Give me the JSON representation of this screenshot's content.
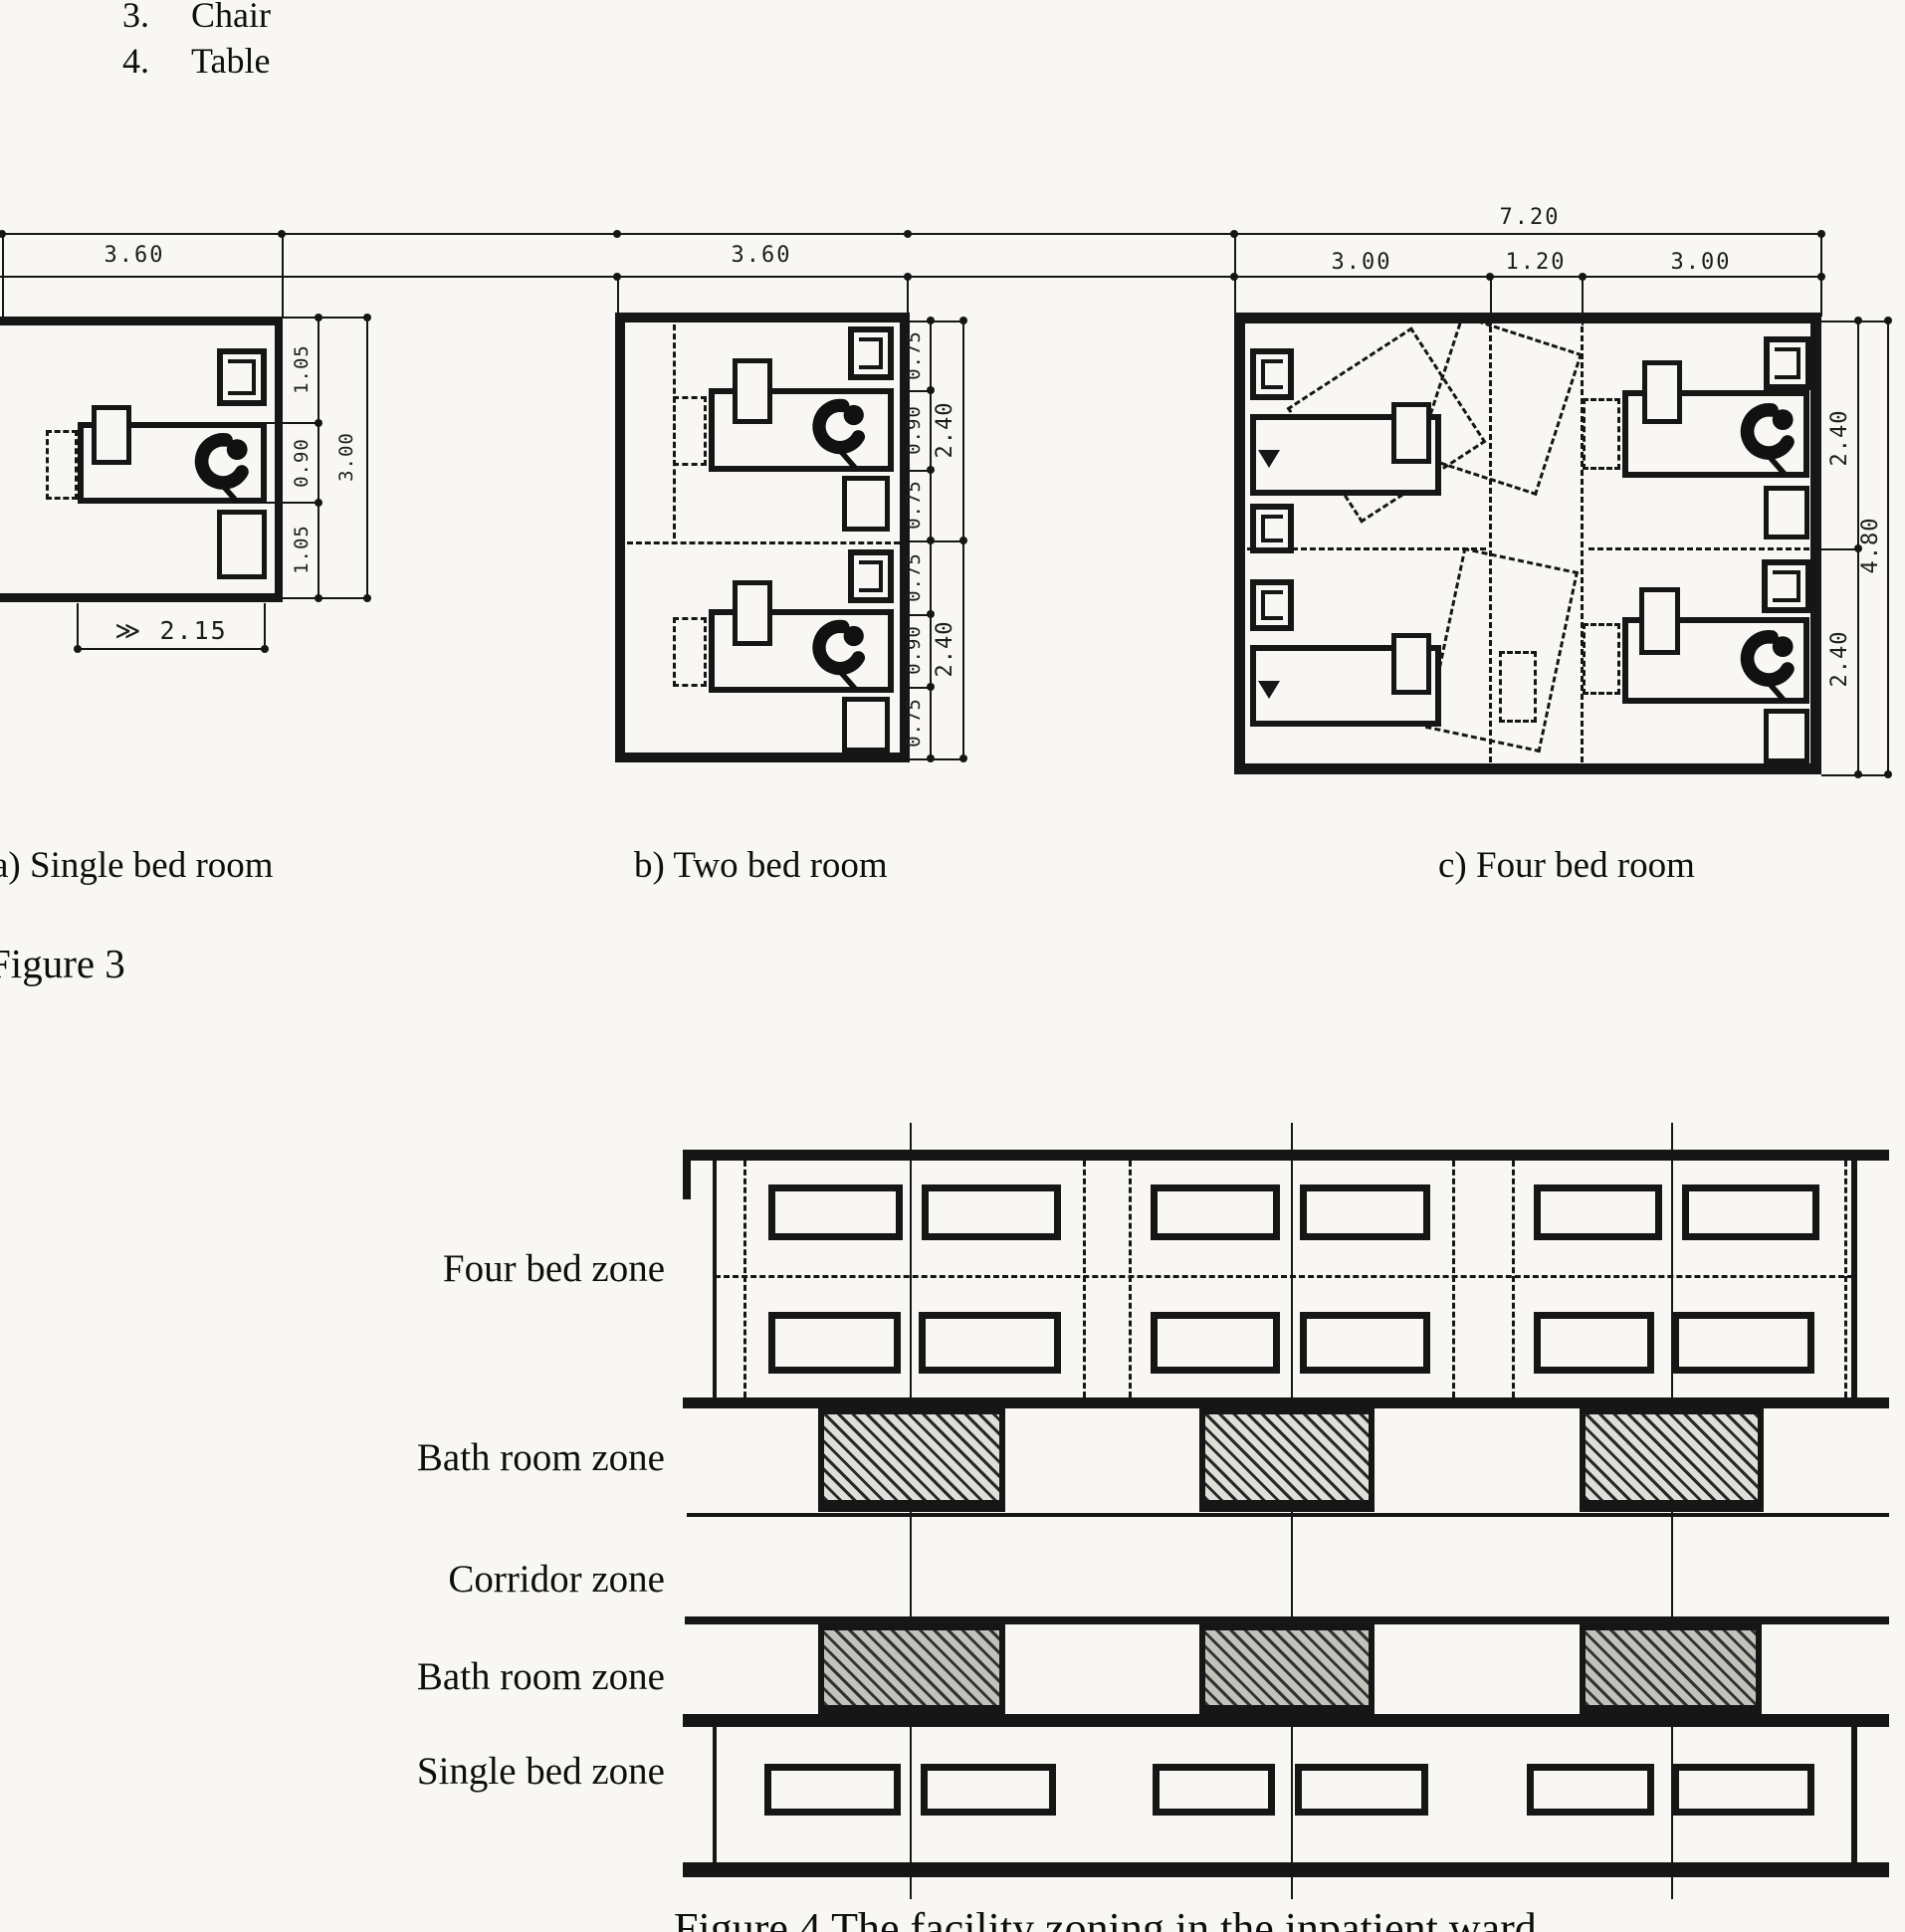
{
  "header": {
    "list_items": [
      {
        "number": "3.",
        "label": "Chair"
      },
      {
        "number": "4.",
        "label": "Table"
      }
    ]
  },
  "figure3": {
    "caption": "Figure 3",
    "room_a": {
      "label": "a) Single bed room",
      "width_dim": "3.60",
      "clearance_dim": "≫ 2.15",
      "side_dims": [
        "1.05",
        "0.90",
        "1.05"
      ],
      "total_height_dim": "3.00"
    },
    "room_b": {
      "label": "b) Two bed room",
      "width_dim": "3.60",
      "side_dims": [
        "0.75",
        "0.90",
        "0.75",
        "0.75",
        "0.90",
        "0.75"
      ],
      "half_dims": [
        "2.40",
        "2.40"
      ]
    },
    "room_c": {
      "label": "c) Four bed room",
      "total_width_dim": "7.20",
      "segment_dims": [
        "3.00",
        "1.20",
        "3.00"
      ],
      "half_dims": [
        "2.40",
        "2.40"
      ],
      "total_height_dim": "4.80"
    }
  },
  "figure4": {
    "zone_labels": [
      "Four bed zone",
      "Bath room zone",
      "Corridor zone",
      "Bath room zone",
      "Single bed zone"
    ],
    "caption": "Figure 4 The facility zoning in the inpatient ward"
  }
}
